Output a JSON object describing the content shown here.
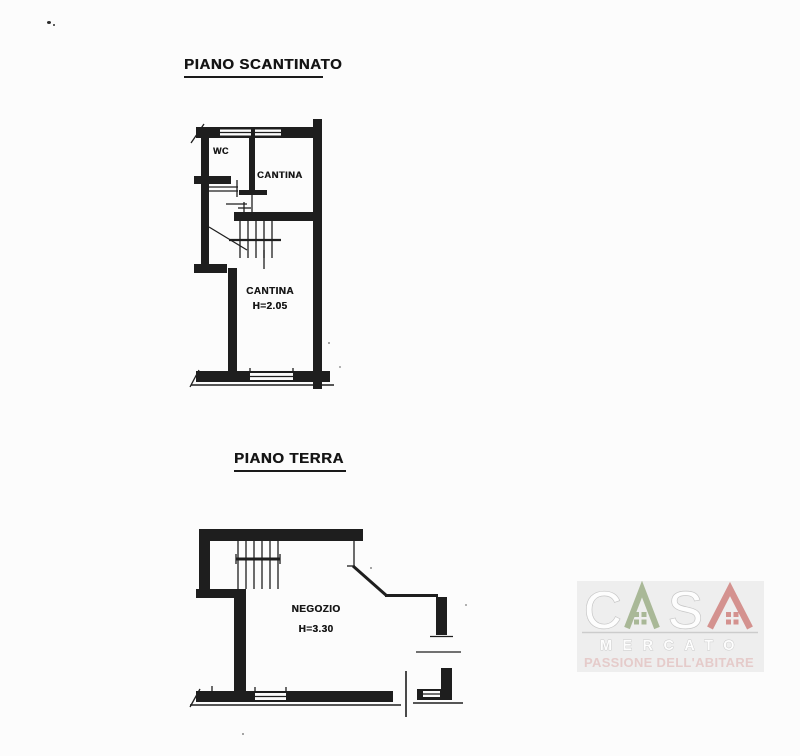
{
  "page": {
    "background_color": "#fcfcfc",
    "ink_color": "#1e1e1e"
  },
  "basement_section": {
    "title": "PIANO SCANTINATO",
    "labels": {
      "wc": "WC",
      "cantina_upper": "CANTINA",
      "cantina_lower_name": "CANTINA",
      "cantina_lower_height": "H=2.05"
    }
  },
  "ground_section": {
    "title": "PIANO TERRA",
    "labels": {
      "negozio_name": "NEGOZIO",
      "negozio_height": "H=3.30"
    }
  },
  "watermark": {
    "brand_word": "CASA",
    "brand_letter_c": "C",
    "brand_letter_s": "S",
    "brand_subword": "MERCATO",
    "tagline": "PASSIONE DELL'ABITARE",
    "colors": {
      "panel": "#eeeeee",
      "house_green": "#a9b897",
      "house_red": "#d4928f",
      "letter_outline": "#c6c6c6",
      "letter_fill": "#fdfdfd",
      "divider": "#cccccc",
      "tagline_pink": "#e5cbca"
    }
  }
}
